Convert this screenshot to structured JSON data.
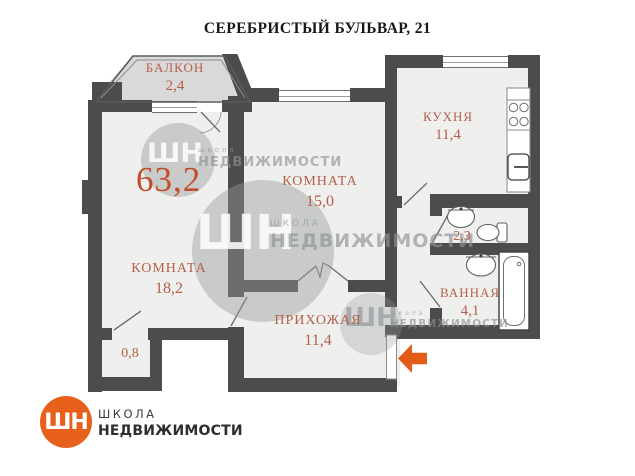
{
  "plan": {
    "title": "СЕРЕБРИСТЫЙ БУЛЬВАР, 21",
    "total_area": "63,2",
    "balcony": {
      "name": "БАЛКОН",
      "area": "2,4"
    },
    "kitchen": {
      "name": "КУХНЯ",
      "area": "11,4"
    },
    "room_middle": {
      "name": "КОМНАТА",
      "area": "15,0"
    },
    "room_left": {
      "name": "КОМНАТА",
      "area": "18,2"
    },
    "hallway": {
      "name": "ПРИХОЖАЯ",
      "area": "11,4"
    },
    "bathroom": {
      "name": "ВАННАЯ",
      "area": "4,1"
    },
    "wc": {
      "area": "2,3"
    },
    "storage": {
      "area": "0,8"
    }
  },
  "watermarks": {
    "logo_glyph": "ШН",
    "school_lower": "школа",
    "school_caps": "ШКОЛА",
    "realty_caps": "НЕДВИЖИМОСТИ"
  },
  "footer": {
    "logo_glyph": "ШН",
    "line1": "ШКОЛА",
    "line2": "НЕДВИЖИМОСТИ"
  },
  "colors": {
    "wall": "#4c4c4c",
    "room_fill": "#efefee",
    "balcony_fill": "#d9d9d9",
    "label": "#b4604a",
    "total_label": "#c14e28",
    "accent_orange": "#e8611c"
  }
}
